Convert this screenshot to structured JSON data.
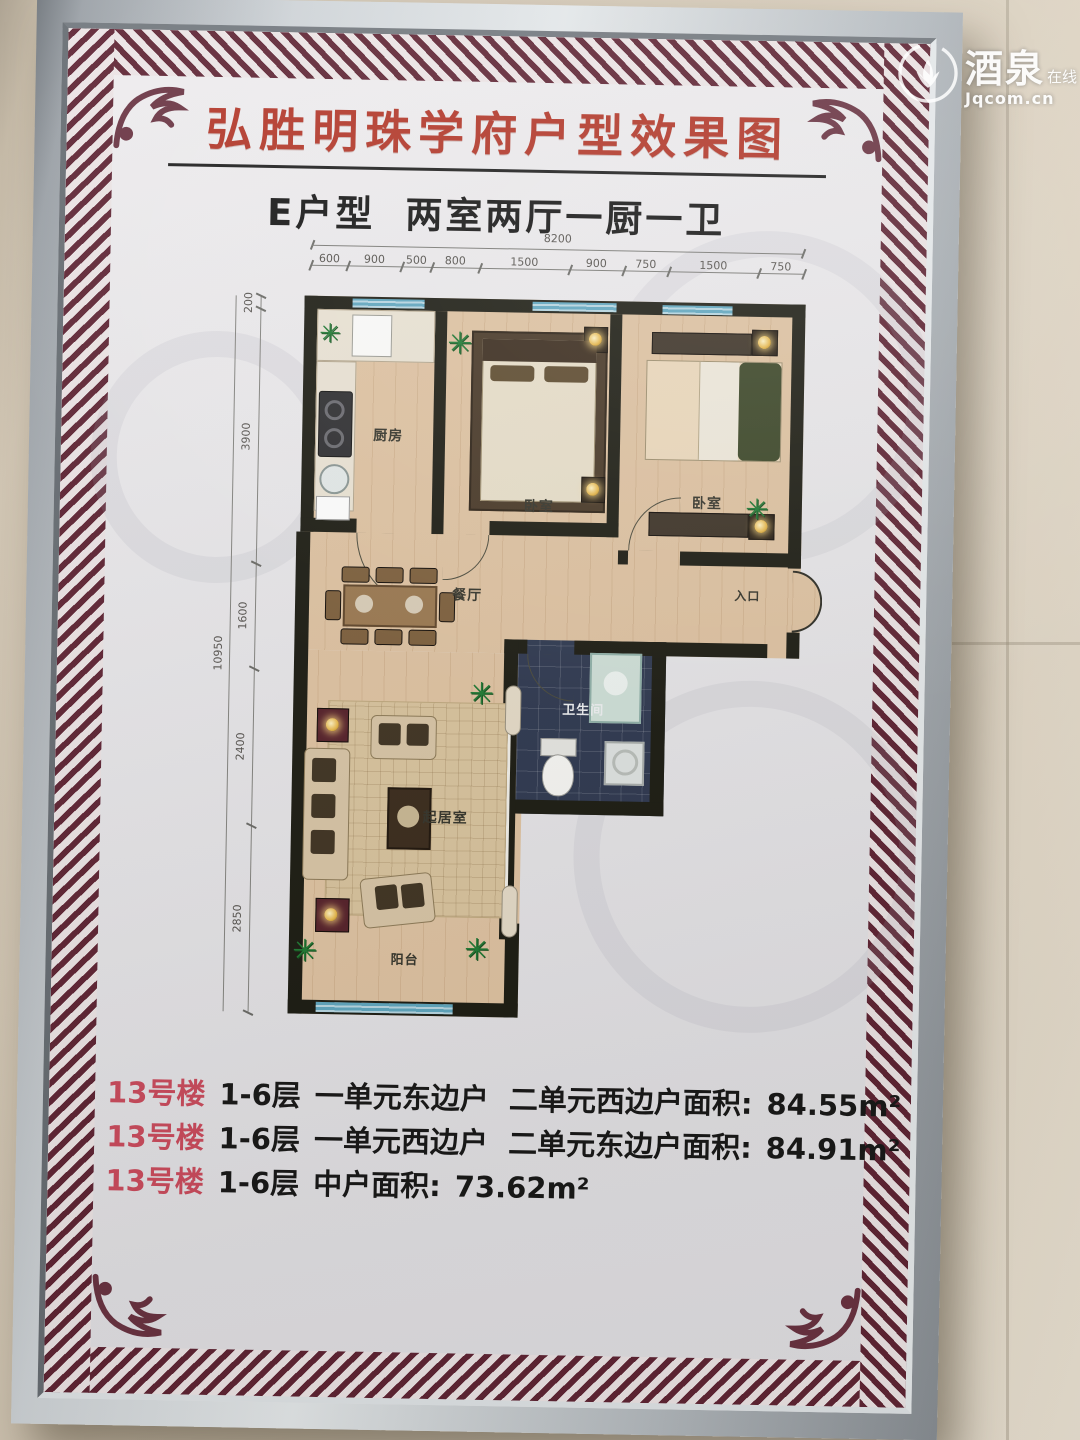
{
  "watermark": {
    "logo": "lotus-logo",
    "name_large": "酒泉",
    "name_small": "在线",
    "url": "Jqcom.cn"
  },
  "poster": {
    "title": "弘胜明珠学府户型效果图",
    "subtitle_type": "E户型",
    "subtitle_layout": "两室两厅一厨一卫",
    "accent_color": "#b23527",
    "border_color": "#5e2333"
  },
  "floor_plan": {
    "dimensions": {
      "top_total": "8200",
      "top_segments": [
        "600",
        "900",
        "500",
        "800",
        "1500",
        "900",
        "750",
        "1500",
        "750"
      ],
      "left_total": "10950",
      "left_segments": [
        "200",
        "3900",
        "1600",
        "2400",
        "2850"
      ]
    },
    "rooms": {
      "kitchen": "厨房",
      "bedroom1": "卧室",
      "bedroom2": "卧室",
      "dining": "餐厅",
      "entrance": "入口",
      "bathroom": "卫生间",
      "living": "起居室",
      "balcony": "阳台"
    }
  },
  "notes": [
    {
      "building": "13号楼",
      "floors": "1-6层",
      "desc": "一单元东边户  二单元西边户面积:",
      "area": "84.55m²"
    },
    {
      "building": "13号楼",
      "floors": "1-6层",
      "desc": "一单元西边户  二单元东边户面积:",
      "area": "84.91m²"
    },
    {
      "building": "13号楼",
      "floors": "1-6层",
      "desc": "中户面积:",
      "area": "73.62m²"
    }
  ]
}
